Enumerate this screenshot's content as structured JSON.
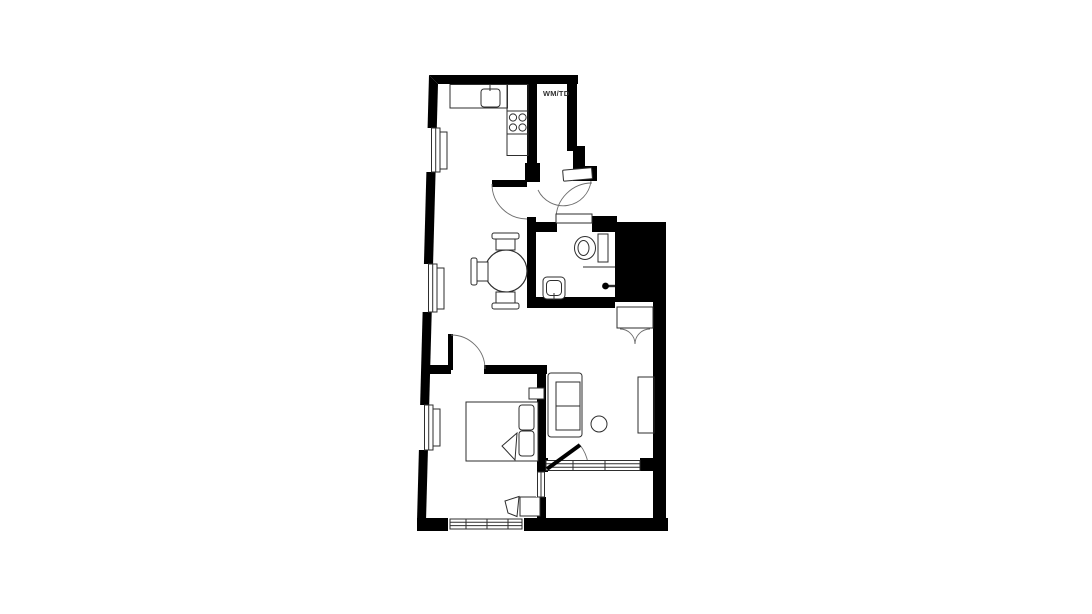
{
  "floorplan": {
    "labels": {
      "utility_closet": "WM/TD"
    },
    "colors": {
      "wall": "#000000",
      "line": "#2e2e2e",
      "arc": "#6e6e6e",
      "background": "#ffffff"
    }
  }
}
